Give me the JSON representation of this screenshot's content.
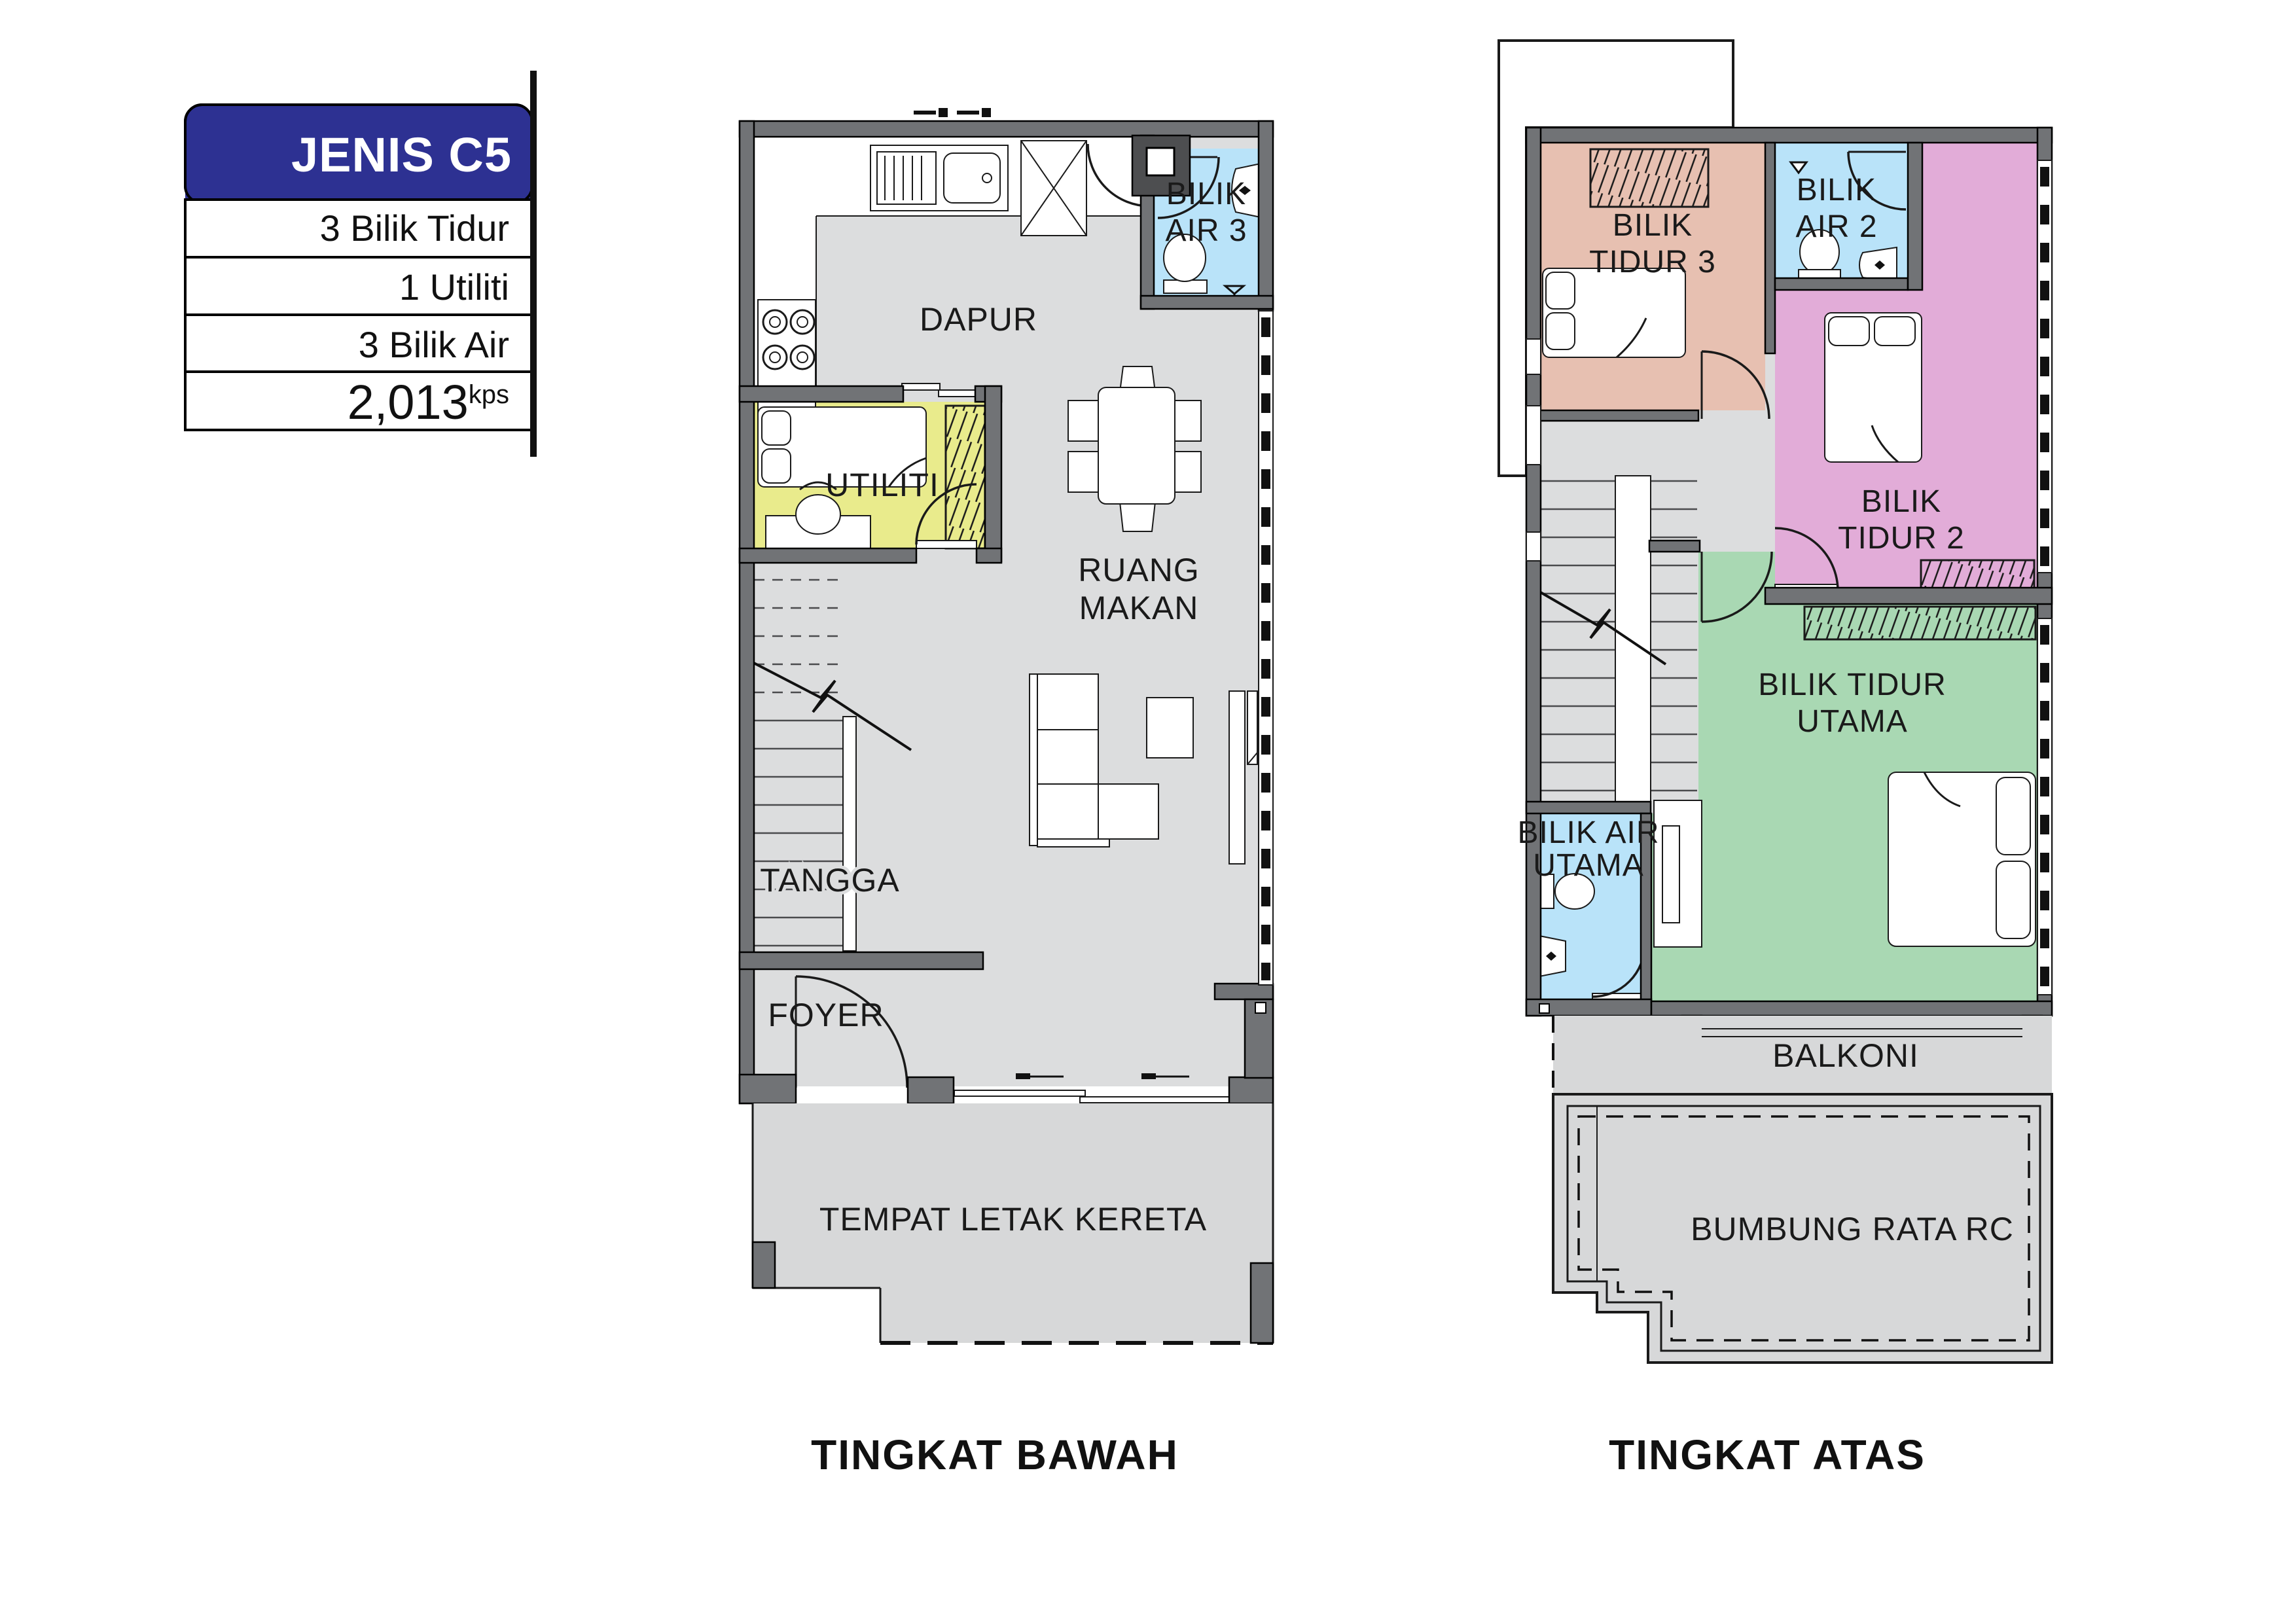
{
  "info_panel": {
    "title": "JENIS C5",
    "rows": [
      "3 Bilik Tidur",
      "1 Utiliti",
      "3 Bilik Air"
    ],
    "area_value": "2,013",
    "area_unit": "kps"
  },
  "ground_floor": {
    "title": "TINGKAT BAWAH",
    "rooms": {
      "dapur": "DAPUR",
      "bilik_air_3": [
        "BILIK",
        "AIR 3"
      ],
      "utiliti": "UTILITI",
      "ruang_makan": [
        "RUANG",
        "MAKAN"
      ],
      "tangga": "TANGGA",
      "foyer": "FOYER",
      "tempat_letak_kereta": "TEMPAT LETAK KERETA"
    }
  },
  "upper_floor": {
    "title": "TINGKAT ATAS",
    "rooms": {
      "bilik_tidur_3": [
        "BILIK",
        "TIDUR 3"
      ],
      "bilik_air_2": [
        "BILIK",
        "AIR 2"
      ],
      "bilik_tidur_2": [
        "BILIK",
        "TIDUR 2"
      ],
      "bilik_tidur_utama": [
        "BILIK TIDUR",
        "UTAMA"
      ],
      "bilik_air_utama": [
        "BILIK AIR",
        "UTAMA"
      ],
      "balkoni": "BALKONI",
      "bumbung_rata_rc": "BUMBUNG RATA RC"
    }
  },
  "colors": {
    "header_blue": "#2D3192",
    "wall": "#717376",
    "wall_dark": "#4D4E50",
    "floor": "#DCDDDE",
    "porch": "#D7D8D9",
    "bathroom_blue": "#B9E3F9",
    "utility_yellow": "#E9EB8C",
    "bedroom3_salmon": "#E7C0B1",
    "bedroom2_magenta": "#E2ACD8",
    "master_green": "#A9D8B3"
  }
}
